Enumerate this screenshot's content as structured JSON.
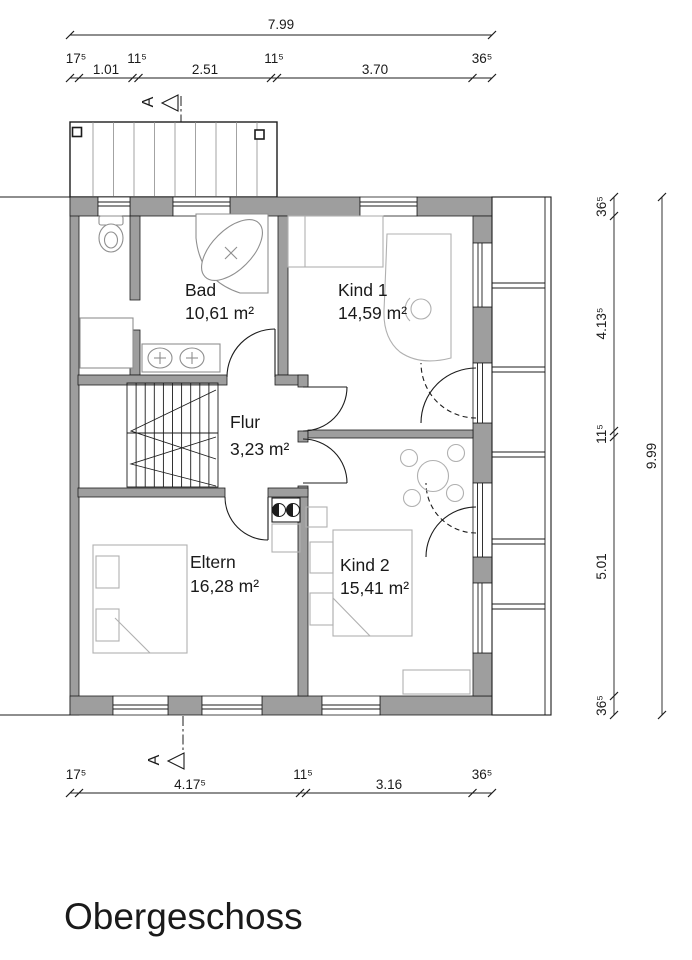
{
  "title": "Obergeschoss",
  "rooms": {
    "bad": {
      "name": "Bad",
      "area": "10,61 m²"
    },
    "kind1": {
      "name": "Kind 1",
      "area": "14,59 m²"
    },
    "flur": {
      "name": "Flur",
      "area": "3,23 m²"
    },
    "eltern": {
      "name": "Eltern",
      "area": "16,28 m²"
    },
    "kind2": {
      "name": "Kind 2",
      "area": "15,41 m²"
    }
  },
  "dimensions": {
    "top": {
      "overall": "7.99",
      "segments": [
        "17⁵",
        "1.01",
        "11⁵",
        "2.51",
        "11⁵",
        "3.70",
        "36⁵"
      ]
    },
    "bottom": {
      "segments": [
        "17⁵",
        "4.17⁵",
        "11⁵",
        "3.16",
        "36⁵"
      ]
    },
    "right": {
      "overall": "9.99",
      "segments": [
        "36⁵",
        "4.13⁵",
        "11⁵",
        "5.01",
        "36⁵"
      ]
    }
  },
  "section_marker": {
    "label": "A"
  },
  "symbols": [
    "bathtub",
    "toilet",
    "shower-tray",
    "double-sink-vanity",
    "stairs",
    "bed",
    "desk-with-chair",
    "round-table-with-chairs",
    "cooktop",
    "balcony",
    "terrace"
  ],
  "colors": {
    "wall": "#9e9e9e",
    "outline": "#1c1c1c",
    "furniture": "#b0b0b0",
    "fixture": "#8f8f8f"
  }
}
